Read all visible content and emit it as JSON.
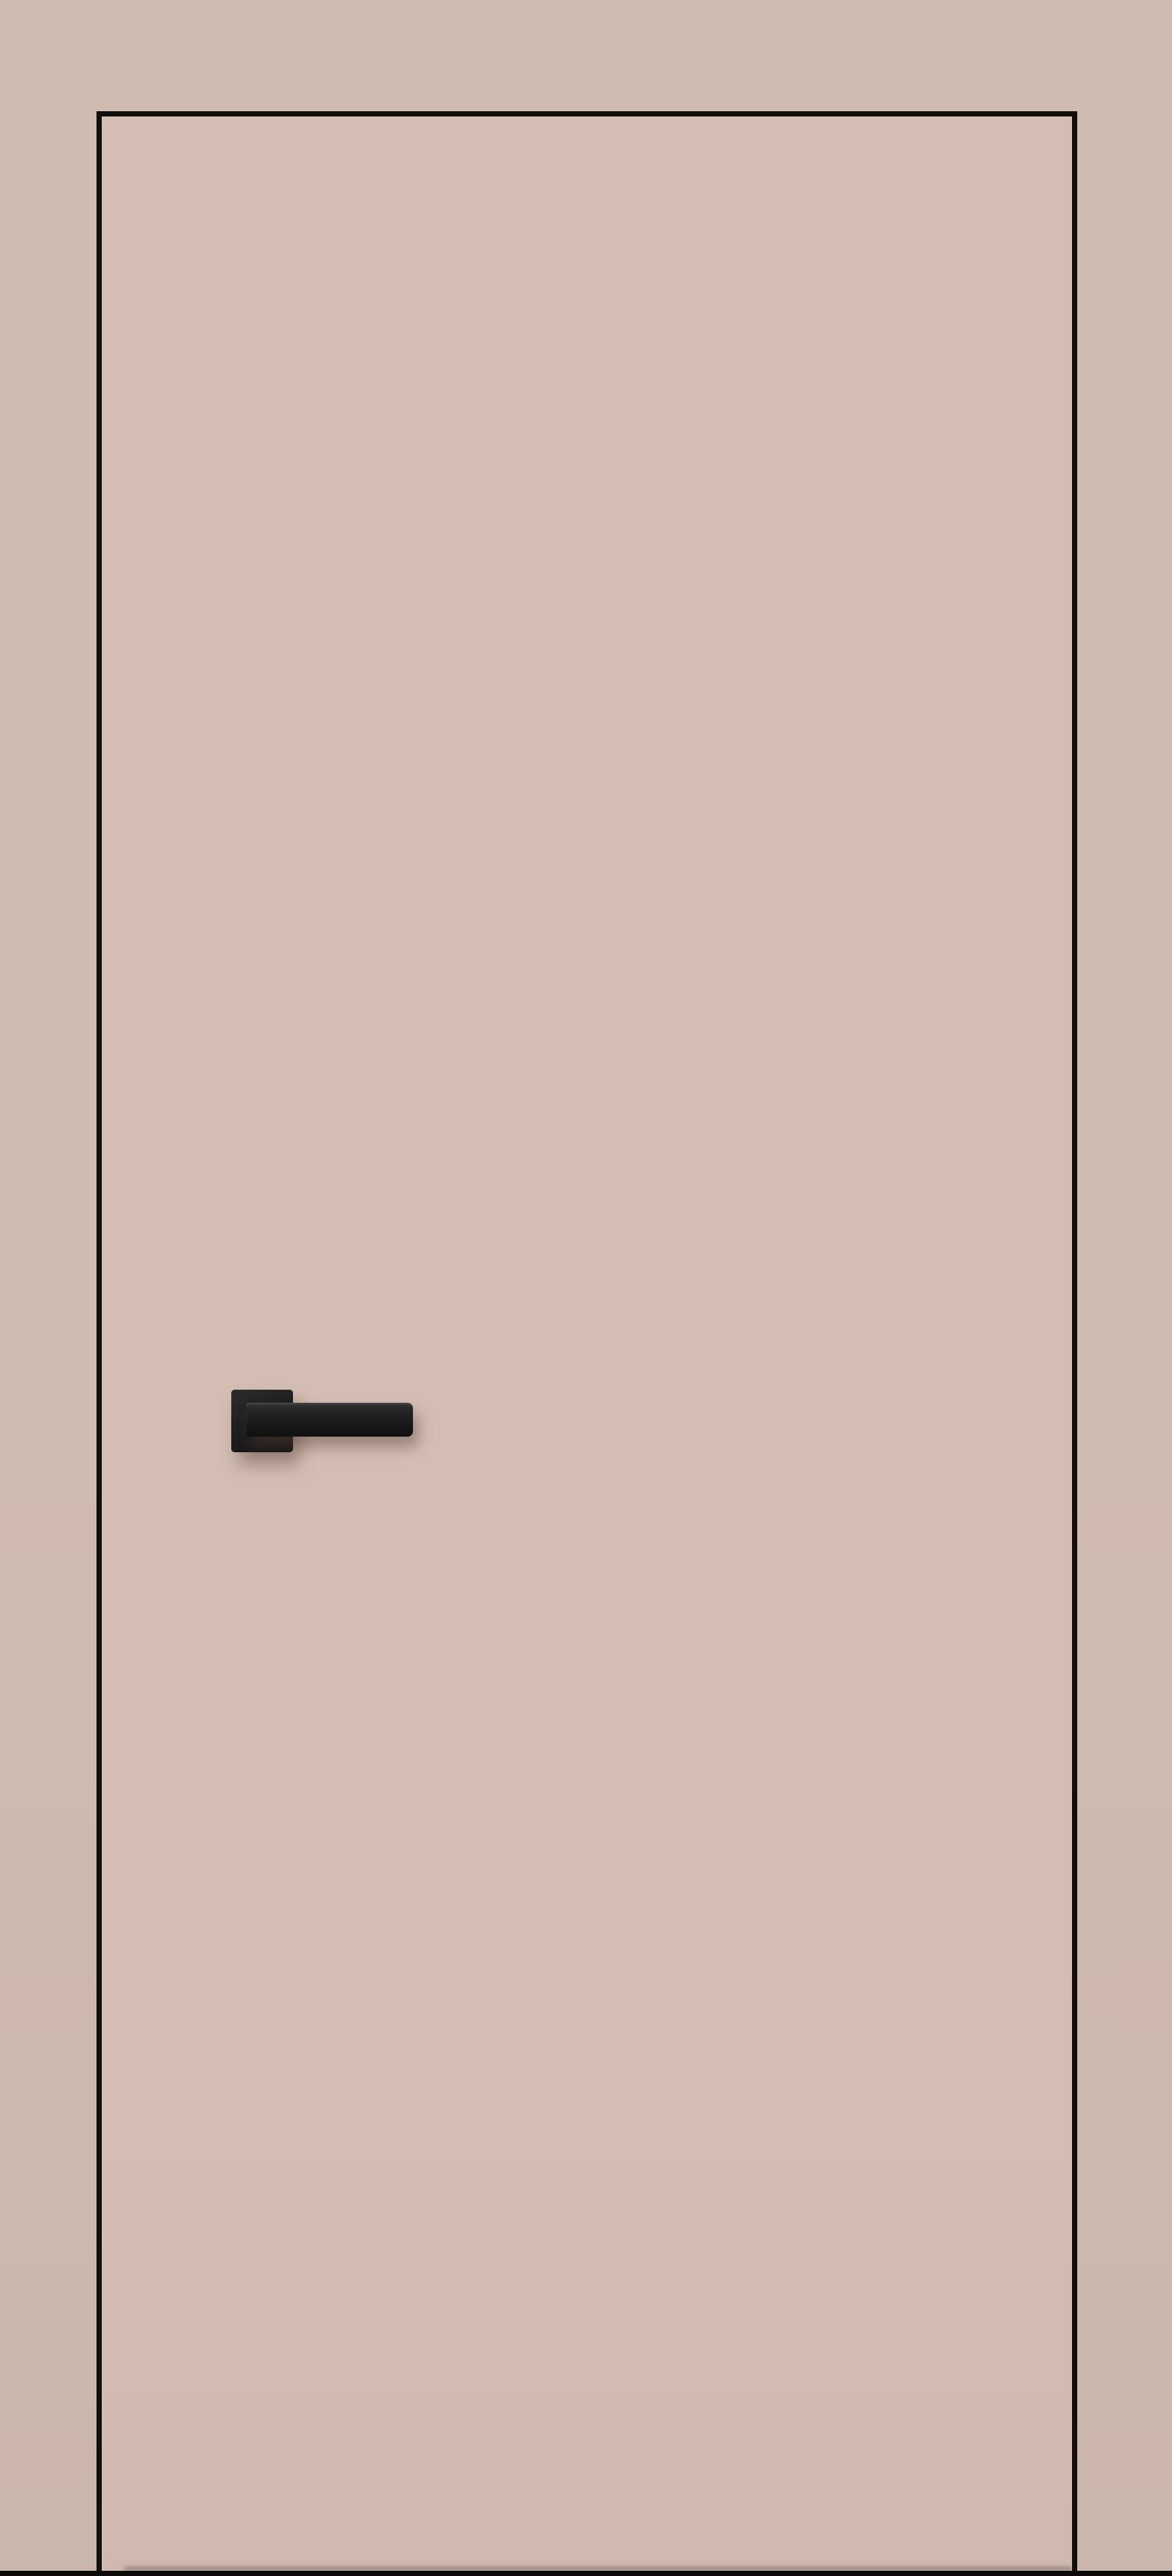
{
  "meta": {
    "title": "Interior flush door with black square-rosette lever handle",
    "image_type": "product-photo",
    "visible_text": ""
  },
  "scene": {
    "wall": {
      "name": "wall-background",
      "color": "#d0bbb1",
      "color_bottom": "#cbb6ac"
    },
    "door": {
      "name": "door-leaf",
      "style": "flush, frameless, concealed hinges",
      "face_color": "#d4beb4",
      "face_color_bottom": "#d0bab0",
      "edge_color": "#12100e"
    },
    "handle": {
      "name": "door-handle",
      "type": "square rosette with straight lever, pointing right",
      "rosette_color": "#1f1f1f",
      "lever_color": "#181818",
      "shadow_color": "rgba(84,62,53,0.45)"
    },
    "floor_line_color": "#0c0b0a"
  }
}
